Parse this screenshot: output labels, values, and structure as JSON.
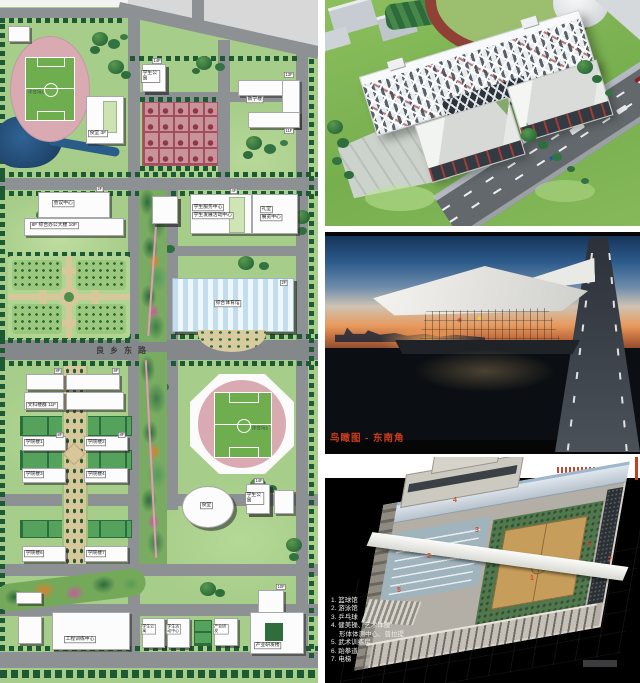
{
  "map": {
    "road": "良乡东路",
    "labels": {
      "stadium1": "体育场1",
      "stadium2": "体育场2",
      "dorm_n": "学生公寓",
      "fl14": "14F",
      "canteen_n": "食堂 3F",
      "teaching": "教学楼",
      "fl13": "13F",
      "fl11": "11F",
      "conference": "会议中心",
      "fl2": "2F",
      "office": "8F 综合办公大楼 10F",
      "service1": "学生服务中心",
      "service2": "学生发展活动中心",
      "fl4": "4F",
      "hall1": "礼堂",
      "hall2": "展览中心",
      "gym": "综合体育馆",
      "liberal": "文科楼群 11F",
      "fl8": "8F",
      "college1": "学院楼1",
      "college2": "学院楼2",
      "college3": "学院楼3",
      "college4": "学院楼4",
      "college6": "学院楼6",
      "college7": "学院楼7",
      "canteen_s": "食堂",
      "training": "工程训练中心",
      "activity": "学生活动中心",
      "industry_small": "产业研发",
      "industry": "产业研发楼",
      "fl10": "10F"
    }
  },
  "captions": {
    "aerial_night": "鸟瞰图 - 东南角"
  },
  "legend": {
    "items": [
      "1. 篮球馆",
      "2. 游泳馆",
      "3. 乒乓球",
      "4. 健美操、艺术体操",
      "形体体测中心、普拉提",
      "5. 武术训练房",
      "6. 跆拳道",
      "7. 电梯"
    ]
  },
  "markers": [
    "1",
    "2",
    "3",
    "4",
    "5",
    "6",
    "7"
  ],
  "colors": {
    "caption_red": "#cf3d1d",
    "map_lawn": "#a6cd89",
    "track_pink": "#d9aab2",
    "water_blue": "#24527d",
    "road_gray": "#8e9194"
  }
}
